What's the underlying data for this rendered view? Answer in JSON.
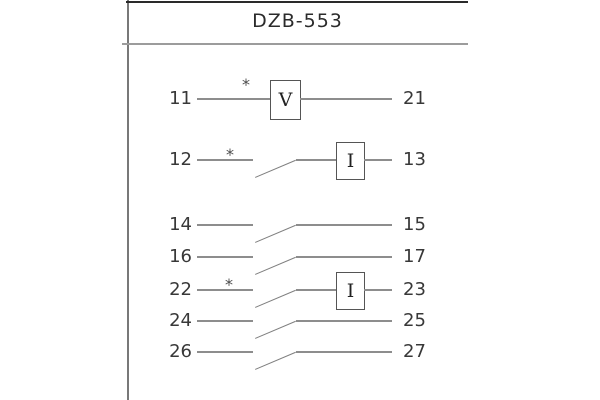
{
  "title": "DZB-553",
  "rows": [
    {
      "left": "11",
      "right": "21",
      "element": "V",
      "star": "*"
    },
    {
      "left": "12",
      "right": "13",
      "element": "I",
      "star": "*"
    },
    {
      "left": "14",
      "right": "15"
    },
    {
      "left": "16",
      "right": "17"
    },
    {
      "left": "22",
      "right": "23",
      "element": "I",
      "star": "*"
    },
    {
      "left": "24",
      "right": "25"
    },
    {
      "left": "26",
      "right": "27"
    }
  ],
  "colors": {
    "background": "#ffffff",
    "top_rule": "#2a2a2a",
    "divider_rule": "#9c9c9c",
    "left_border": "#787878",
    "wire": "#8d8d8d",
    "text": "#383838"
  }
}
